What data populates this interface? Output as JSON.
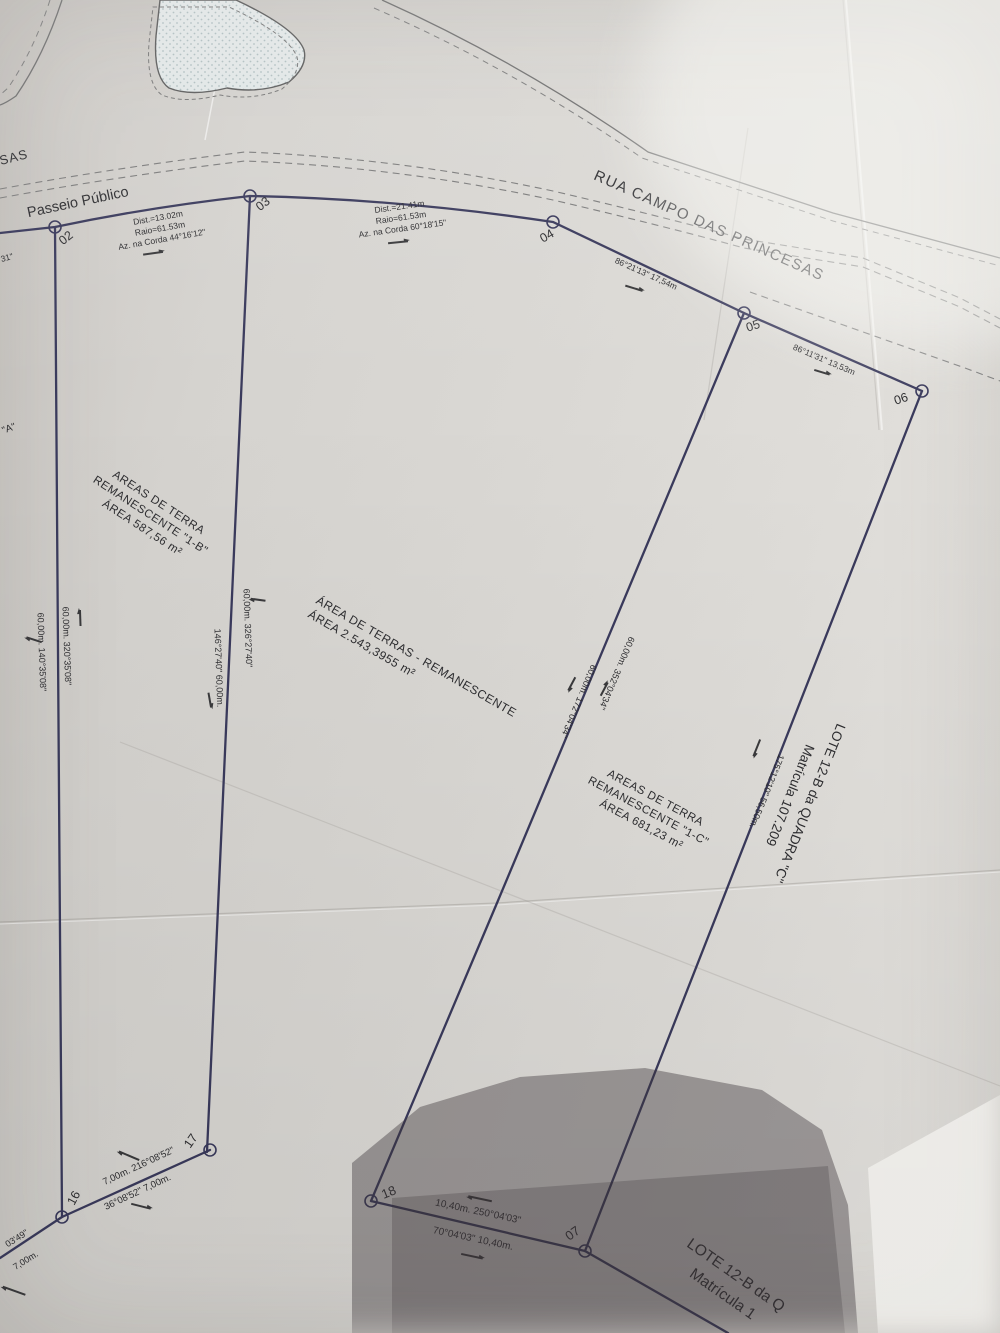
{
  "streets": {
    "main": "RUA CAMPO DAS PRINCESAS",
    "sidewalk": "Passeio Público",
    "partial_top_left": "SAS"
  },
  "curve_notes": [
    {
      "dist": "Dist.=13.02m",
      "radius": "Raio=61.53m",
      "azimuth": "Az. na Corda  44°16'12\""
    },
    {
      "dist": "Dist.=21.41m",
      "radius": "Raio=61.53m",
      "azimuth": "Az. na Corda  60°18'15\""
    }
  ],
  "bearings": {
    "seg_04_05": "86°21'13\"  17,54m",
    "seg_05_06": "86°11'31\"  13,53m",
    "left_line_east": "60,00m.  320°35'08\"",
    "left_line_west": "60,00m.  140°35'08\"",
    "line_1b_east": "60,00m.  326°27'40\"",
    "line_1b_west": "146°27'40\"  60,00m.",
    "line_mid_east": "60,00m.  352°04'34\"",
    "line_mid_west": "60,00m.  172°04'34\"",
    "line_1c_east": "175°12'10\"  56,50m.",
    "seg_17_16_north": "7,00m.  216°08'52\"",
    "seg_17_16_south": "36°08'52\"  7,00m.",
    "seg_18_07_north": "10,40m.  250°04'03\"",
    "seg_18_07_south": "70°04'03\"  10,40m.",
    "corner_partial_azimuth": "03'49\"",
    "corner_partial_distance": "7,00m.",
    "edge_partial_seconds": "31\"",
    "edge_partial_quote": "\"A\""
  },
  "areas": {
    "rem_1b": {
      "line1": "AREAS DE TERRA",
      "line2": "REMANESCENTE \"1-B\"",
      "line3": "ÁREA 587,56 m²"
    },
    "central": {
      "line1": "ÁREA DE TERRAS  - REMANESCENTE",
      "line2": "ÁREA 2.543,3955 m²"
    },
    "rem_1c": {
      "line1": "AREAS DE TERRA",
      "line2": "REMANESCENTE \"1-C\"",
      "line3": "ÁREA  681,23 m²"
    }
  },
  "lots": {
    "east": {
      "line1": "LOTE 12-B da QUADRA \"C\"",
      "line2": "Matrícula 107.209"
    },
    "south": {
      "line1": "LOTE 12-B da Q",
      "line2": "Matrícula 1"
    }
  },
  "vertices": [
    "02",
    "03",
    "04",
    "05",
    "06",
    "07",
    "16",
    "17",
    "18"
  ]
}
